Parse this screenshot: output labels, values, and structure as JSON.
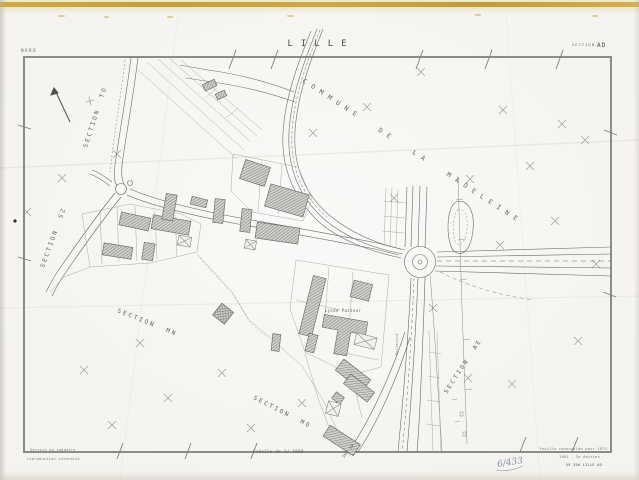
{
  "header": {
    "nord": "NORD",
    "title": "LILLE",
    "section_label": "SECTION",
    "section_value": "AD"
  },
  "map_labels": {
    "commune": "COMMUNE DE LA MADELEINE",
    "section_to": "SECTION TO",
    "section_sz": "SECTION SZ",
    "section_mn": "SECTION MN",
    "section_mo": "SECTION MO",
    "section_ae": "SECTION AE",
    "lycee": "Lycée Pasteur",
    "boulevard": "Boulevard",
    "bd_hp": "5me HP"
  },
  "footer": {
    "credit_line1": "Service du cadastre",
    "credit_line2": "reproduction interdite",
    "scale": "Echelle de 1/ 1000",
    "right_line1": "Feuille renouvelée pour 1973",
    "right_line2": "1981 - 3e édition",
    "right_line3": "59 350 LILLE AD",
    "handwritten": "6/433"
  },
  "colors": {
    "paper": "#f4f3ef",
    "gold_band": "#c9a23e",
    "ink": "#5a5a5a",
    "map_border": "#8b8b8b",
    "building_fill": "#a8a8a8",
    "handwriting_ink": "#70809a"
  }
}
